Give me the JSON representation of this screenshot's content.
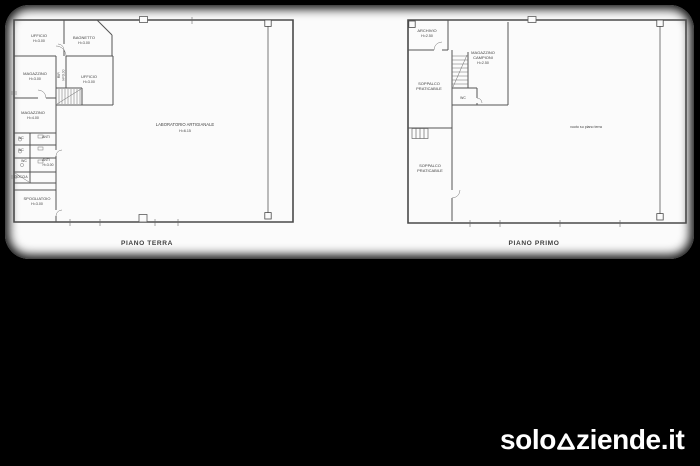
{
  "colors": {
    "background": "#000000",
    "paper": "#fbfbfb",
    "plan_line": "#4a4a4a",
    "plan_text": "#3f3f3f",
    "faint_text": "#8a8a8a",
    "logo": "#ffffff"
  },
  "ground_floor": {
    "caption": "PIANO TERRA",
    "rooms": {
      "ufficio_top": {
        "name": "UFFICIO",
        "h": "H=3.00"
      },
      "bagnetto": {
        "name": "BAGNETTO",
        "h": "H=3.00"
      },
      "magazzino_1": {
        "name": "MAGAZZINO",
        "h": "H=3.00"
      },
      "rip": {
        "name": "RIP.",
        "h": "H=3.00"
      },
      "ufficio_2": {
        "name": "UFFICIO",
        "h": "H=3.00"
      },
      "magazzino_2": {
        "name": "MAGAZZINO",
        "h": "H=4.00"
      },
      "wc_1": {
        "name": "WC"
      },
      "anti_1": {
        "name": "ANTI"
      },
      "wc_2": {
        "name": "WC"
      },
      "wc_3": {
        "name": "WC"
      },
      "anti_2": {
        "name": "ANTI",
        "h": "H=3.00"
      },
      "doccia": {
        "name": "DOCCIA"
      },
      "spogliatoio": {
        "name": "SPOGLIATOIO",
        "h": "H=3.00"
      },
      "laboratorio": {
        "name": "LABORATORIO ARTIGIANALE",
        "h": "H=6.15"
      }
    }
  },
  "first_floor": {
    "caption": "PIANO PRIMO",
    "rooms": {
      "archivio": {
        "name": "ARCHIVIO",
        "h": "H=2.50"
      },
      "magazzino_campioni": {
        "line1": "MAGAZZINO",
        "line2": "CAMPIONI",
        "h": "H=2.50"
      },
      "soppalco_sup": {
        "line1": "SOPPALCO",
        "line2": "PRATICABILE"
      },
      "wc": {
        "name": "WC"
      },
      "soppalco_inf": {
        "line1": "SOPPALCO",
        "line2": "PRATICABILE"
      },
      "vuoto": {
        "name": "vuoto su piano terra"
      }
    }
  },
  "watermark": {
    "prefix": "solo",
    "suffix": "ziende.it",
    "full_text": "soloaziende.it"
  }
}
